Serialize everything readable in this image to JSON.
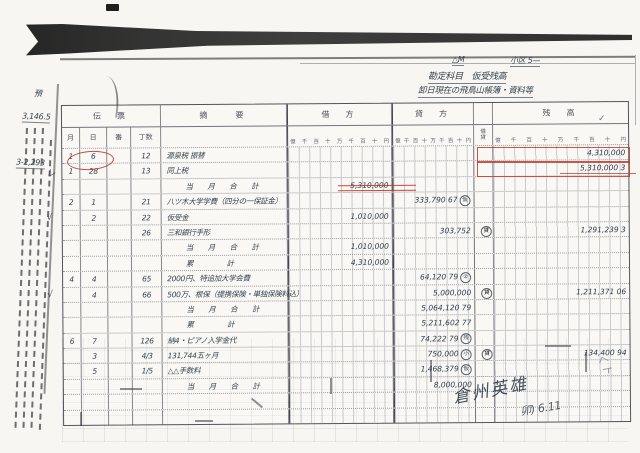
{
  "page": {
    "top_right_label_1": "△M",
    "top_right_label_2": "小区  5—",
    "heading_line_1": "勘定科目　仮受残高",
    "heading_line_2": "卸日現在の飛鳥山帳簿・資料等",
    "side_note_top": "預",
    "side_number_1": "3,146.5",
    "side_number_2": "3-2,293",
    "header_check": "✓",
    "signature_name": "倉州英雄",
    "signature_date": "卯) 6.11",
    "corner_mark": "くト"
  },
  "colors": {
    "red_ink": "#c2382a",
    "pen_ink": "#36434f"
  },
  "table": {
    "headers": {
      "voucher": "伝　票",
      "month": "月",
      "day": "日",
      "slip_no": "番",
      "page_no": "丁数",
      "description": "摘　　要",
      "debit": "借　方",
      "credit": "貸　方",
      "dc_top": "借",
      "dc_bottom": "貸",
      "balance": "残　高"
    },
    "digit_scale": "億千百十万千百十円",
    "rows": [
      {
        "m": "1",
        "d": "6",
        "no": "",
        "no2": "12",
        "desc": "源泉税 振替",
        "debit": "",
        "credit": "",
        "mark": "",
        "dc": "",
        "bal": "4,310,000",
        "check": ""
      },
      {
        "m": "1",
        "d": "28",
        "no": "",
        "no2": "13",
        "desc": "同上税",
        "debit": "",
        "credit": "",
        "mark": "",
        "dc": "",
        "bal": "5,310,000 3",
        "check": "レ"
      },
      {
        "m": "",
        "d": "",
        "no": "",
        "no2": "",
        "desc": "当 月 合 計",
        "debit": "5,310,000",
        "credit": "",
        "mark": "",
        "dc": "",
        "bal": "",
        "check": "",
        "sum": true
      },
      {
        "m": "2",
        "d": "1",
        "no": "",
        "no2": "21",
        "desc": "八ツ木大学学費（四分の一保証金）",
        "debit": "",
        "credit": "333,790 67",
        "mark": "仮",
        "dc": "",
        "bal": "",
        "check": ""
      },
      {
        "m": "",
        "d": "2",
        "no": "",
        "no2": "22",
        "desc": "仮受金",
        "debit": "1,010,000",
        "credit": "",
        "mark": "",
        "dc": "",
        "bal": "",
        "check": "√"
      },
      {
        "m": "",
        "d": "",
        "no": "",
        "no2": "26",
        "desc": "三和銀行手形",
        "debit": "",
        "credit": "303,752",
        "mark": "",
        "dc": "貸",
        "bal": "1,291,239 3",
        "check": ""
      },
      {
        "m": "",
        "d": "",
        "no": "",
        "no2": "",
        "desc": "当 月 合 計",
        "debit": "1,010,000",
        "credit": "",
        "mark": "",
        "dc": "",
        "bal": "",
        "check": "",
        "sum": true
      },
      {
        "m": "",
        "d": "",
        "no": "",
        "no2": "",
        "desc": "累　　計",
        "debit": "4,310,000",
        "credit": "",
        "mark": "",
        "dc": "",
        "bal": "",
        "check": "",
        "sum": true
      },
      {
        "m": "4",
        "d": "4",
        "no": "",
        "no2": "65",
        "desc": "2000円、特追加大学会費",
        "debit": "",
        "credit": "64,120 79",
        "mark": "②",
        "dc": "",
        "bal": "",
        "check": ""
      },
      {
        "m": "",
        "d": "4",
        "no": "",
        "no2": "66",
        "desc": "500万、根保（提携保険・単独保険料込）",
        "debit": "",
        "credit": "5,000,000",
        "mark": "",
        "dc": "貸",
        "bal": "1,211,371 06",
        "check": "√"
      },
      {
        "m": "",
        "d": "",
        "no": "",
        "no2": "",
        "desc": "当 月 合 計",
        "debit": "",
        "credit": "5,064,120 79",
        "mark": "",
        "dc": "",
        "bal": "",
        "check": "",
        "sum": true
      },
      {
        "m": "",
        "d": "",
        "no": "",
        "no2": "",
        "desc": "累　　計",
        "debit": "",
        "credit": "5,211,602 77",
        "mark": "",
        "dc": "",
        "bal": "",
        "check": "",
        "sum": true
      },
      {
        "m": "6",
        "d": "7",
        "no": "",
        "no2": "126",
        "desc": "納4・ピアノ入学金代",
        "debit": "",
        "credit": "74,222 79",
        "mark": "残",
        "dc": "",
        "bal": "",
        "check": ""
      },
      {
        "m": "",
        "d": "3",
        "no": "",
        "no2": "4/3",
        "desc": "131,744五ヶ月",
        "debit": "",
        "credit": "750,000",
        "mark": "小",
        "dc": "貸",
        "bal": "134,400 94",
        "check": ""
      },
      {
        "m": "",
        "d": "5",
        "no": "",
        "no2": "1/5",
        "desc": "△△手数料",
        "debit": "",
        "credit": "1,468,379",
        "mark": "仮",
        "dc": "",
        "bal": "",
        "check": ""
      },
      {
        "m": "",
        "d": "",
        "no": "",
        "no2": "",
        "desc": "当 月 合 計",
        "debit": "",
        "credit": "8,000,000",
        "mark": "",
        "dc": "",
        "bal": "",
        "check": "",
        "sum": true
      },
      {
        "m": "",
        "d": "",
        "no": "",
        "no2": "",
        "desc": "",
        "debit": "",
        "credit": "",
        "mark": "",
        "dc": "",
        "bal": "",
        "check": ""
      },
      {
        "m": "",
        "d": "",
        "no": "",
        "no2": "",
        "desc": "",
        "debit": "",
        "credit": "",
        "mark": "",
        "dc": "",
        "bal": "",
        "check": ""
      }
    ]
  }
}
